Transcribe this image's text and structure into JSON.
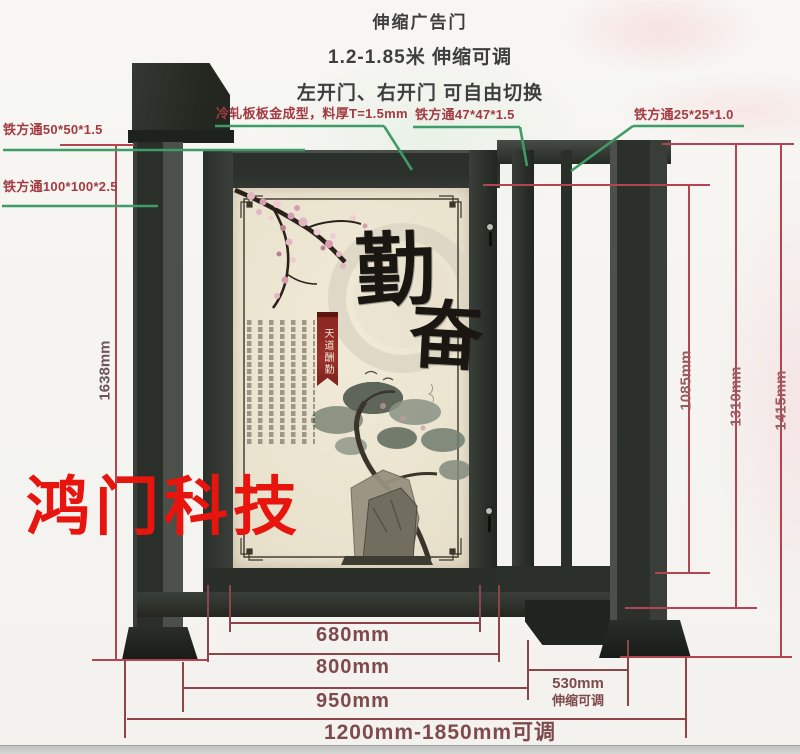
{
  "header": {
    "title": "伸缩广告门",
    "subtitle": "1.2-1.85米 伸缩可调",
    "note": "左开门、右开门 可自由切换"
  },
  "callouts": {
    "tube_50": "铁方通50*50*1.5",
    "tube_100": "铁方通100*100*2.5",
    "cold_rolled_panel": "冷轧板板金成型，料厚T=1.5mm",
    "tube_47": "铁方通47*47*1.5",
    "tube_25": "铁方通25*25*1.0"
  },
  "dimensions": {
    "total_height": "1638mm",
    "inner_height": "1085mm",
    "frame_height": "1310mm",
    "post_height": "1415mm",
    "panel_width": "680mm",
    "door_width": "800mm",
    "door_section_width": "950mm",
    "telescopic_width": "530mm",
    "telescopic_note": "伸缩可调",
    "total_width_range": "1200mm-1850mm可调"
  },
  "watermark": "鸿门科技",
  "artwork": {
    "calligraphy_top": "勤",
    "calligraphy_bottom": "奋",
    "seal_banner": "天道酬勤"
  },
  "colors": {
    "dimension_line": "#b24550",
    "bottom_dimension_line": "#8d4549",
    "leader_line": "#3f9b67",
    "label_red": "#a33b42",
    "watermark_red": "#e8150e",
    "gate_dark": "#2a2e2a",
    "panel_cream": "#ece5d1"
  }
}
